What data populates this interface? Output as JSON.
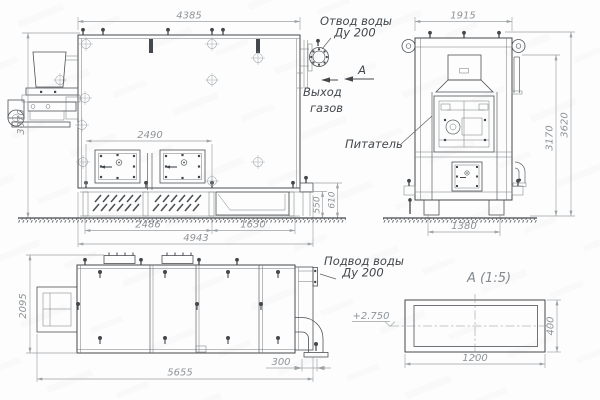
{
  "colors": {
    "background": "#fdfdfd",
    "line_main": "#44484c",
    "line_thin": "#75797d",
    "line_dimension": "#9ba1a5",
    "text_dimension": "#8e9397",
    "text_label": "#42474c"
  },
  "front": {
    "dim_width": "4385",
    "dim_height": "3070",
    "dim_doors": "2490",
    "dim_base_left": "2486",
    "dim_base_right": "1630",
    "dim_base_total": "4943",
    "dim_base_h1": "550",
    "dim_base_h2": "610",
    "label_water_outlet_1": "Отвод воды",
    "label_water_outlet_2": "Ду 200",
    "label_gas_1": "Выход",
    "label_gas_2": "газов",
    "section_marker": "А"
  },
  "side": {
    "dim_width": "1915",
    "dim_h_inner": "3170",
    "dim_h_outer": "3620",
    "dim_base": "1380",
    "label_feeder": "Питатель"
  },
  "plan": {
    "dim_depth": "2095",
    "dim_length": "5655",
    "dim_pipe": "300",
    "label_water_supply_1": "Подвод воды",
    "label_water_supply_2": "Ду 200"
  },
  "section_a": {
    "title": "А (1:5)",
    "dim_width": "1200",
    "dim_height": "400",
    "elevation": "+2.750"
  }
}
